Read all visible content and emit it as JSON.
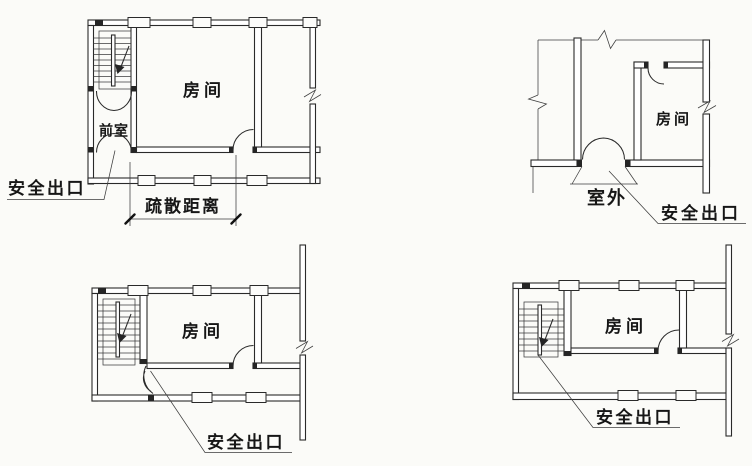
{
  "figure": {
    "colors": {
      "ink": "#2a2a2a",
      "paper": "#fbfbf8"
    },
    "plans": {
      "top_left": {
        "room": "房间",
        "vestibule": "前室",
        "safety_exit": "安全出口",
        "evacuation_distance": "疏散距离"
      },
      "top_right": {
        "room": "房间",
        "outdoor": "室外",
        "safety_exit": "安全出口"
      },
      "bottom_left": {
        "room": "房间",
        "safety_exit": "安全出口"
      },
      "bottom_right": {
        "room": "房间",
        "safety_exit": "安全出口"
      }
    }
  }
}
